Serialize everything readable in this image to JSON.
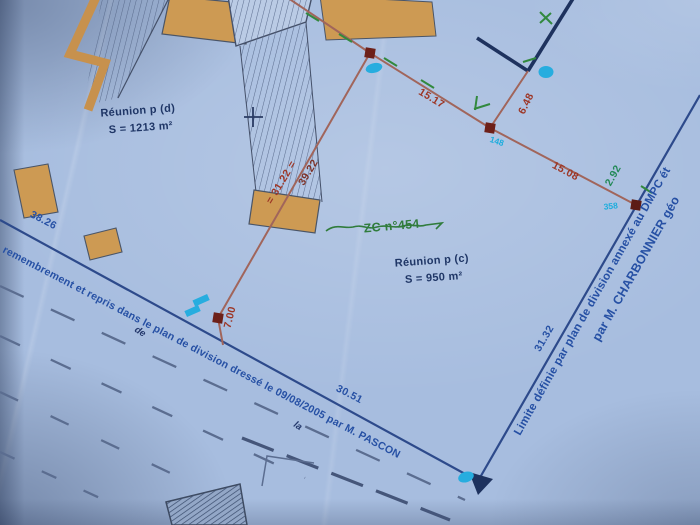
{
  "plan": {
    "parcel_d": {
      "label": "Réunion p  (d)",
      "area": "S = 1213 m²"
    },
    "parcel_c": {
      "label": "Réunion p  (c)",
      "area": "S = 950 m²"
    },
    "parcel_zc": {
      "label": "ZC n°454"
    },
    "measurements": {
      "ab": "15.17",
      "bc": "15.08",
      "bf": "6.48",
      "c_up": "2.92",
      "ad_left": "= 31.22 =",
      "ad_right": "39.22",
      "d_down": "7.00",
      "left_road": "38.26",
      "right_lower": "31.32",
      "bottom_road": "30.51"
    },
    "point_labels": {
      "near_b": "148",
      "near_c": "358"
    },
    "street_words": {
      "word1": "de",
      "word2": "la"
    },
    "boundary_notes": {
      "left": "remembrement et repris dans le plan de division dressé le 09/08/2005 par M. PASCON",
      "right_line1": "Limite définie par plan de division annexé au DMPC ét",
      "right_line2": "par M. CHARBONNIER géo"
    },
    "colors": {
      "paper": "#a7bddf",
      "boundary_blue": "#2c4a8e",
      "navy": "#1d3260",
      "red_line": "#a3655a",
      "red_text": "#a03524",
      "green": "#2e7d3a",
      "cyan": "#18aee0",
      "orange": "#cf9a50",
      "note_blue": "#2450a8"
    }
  }
}
